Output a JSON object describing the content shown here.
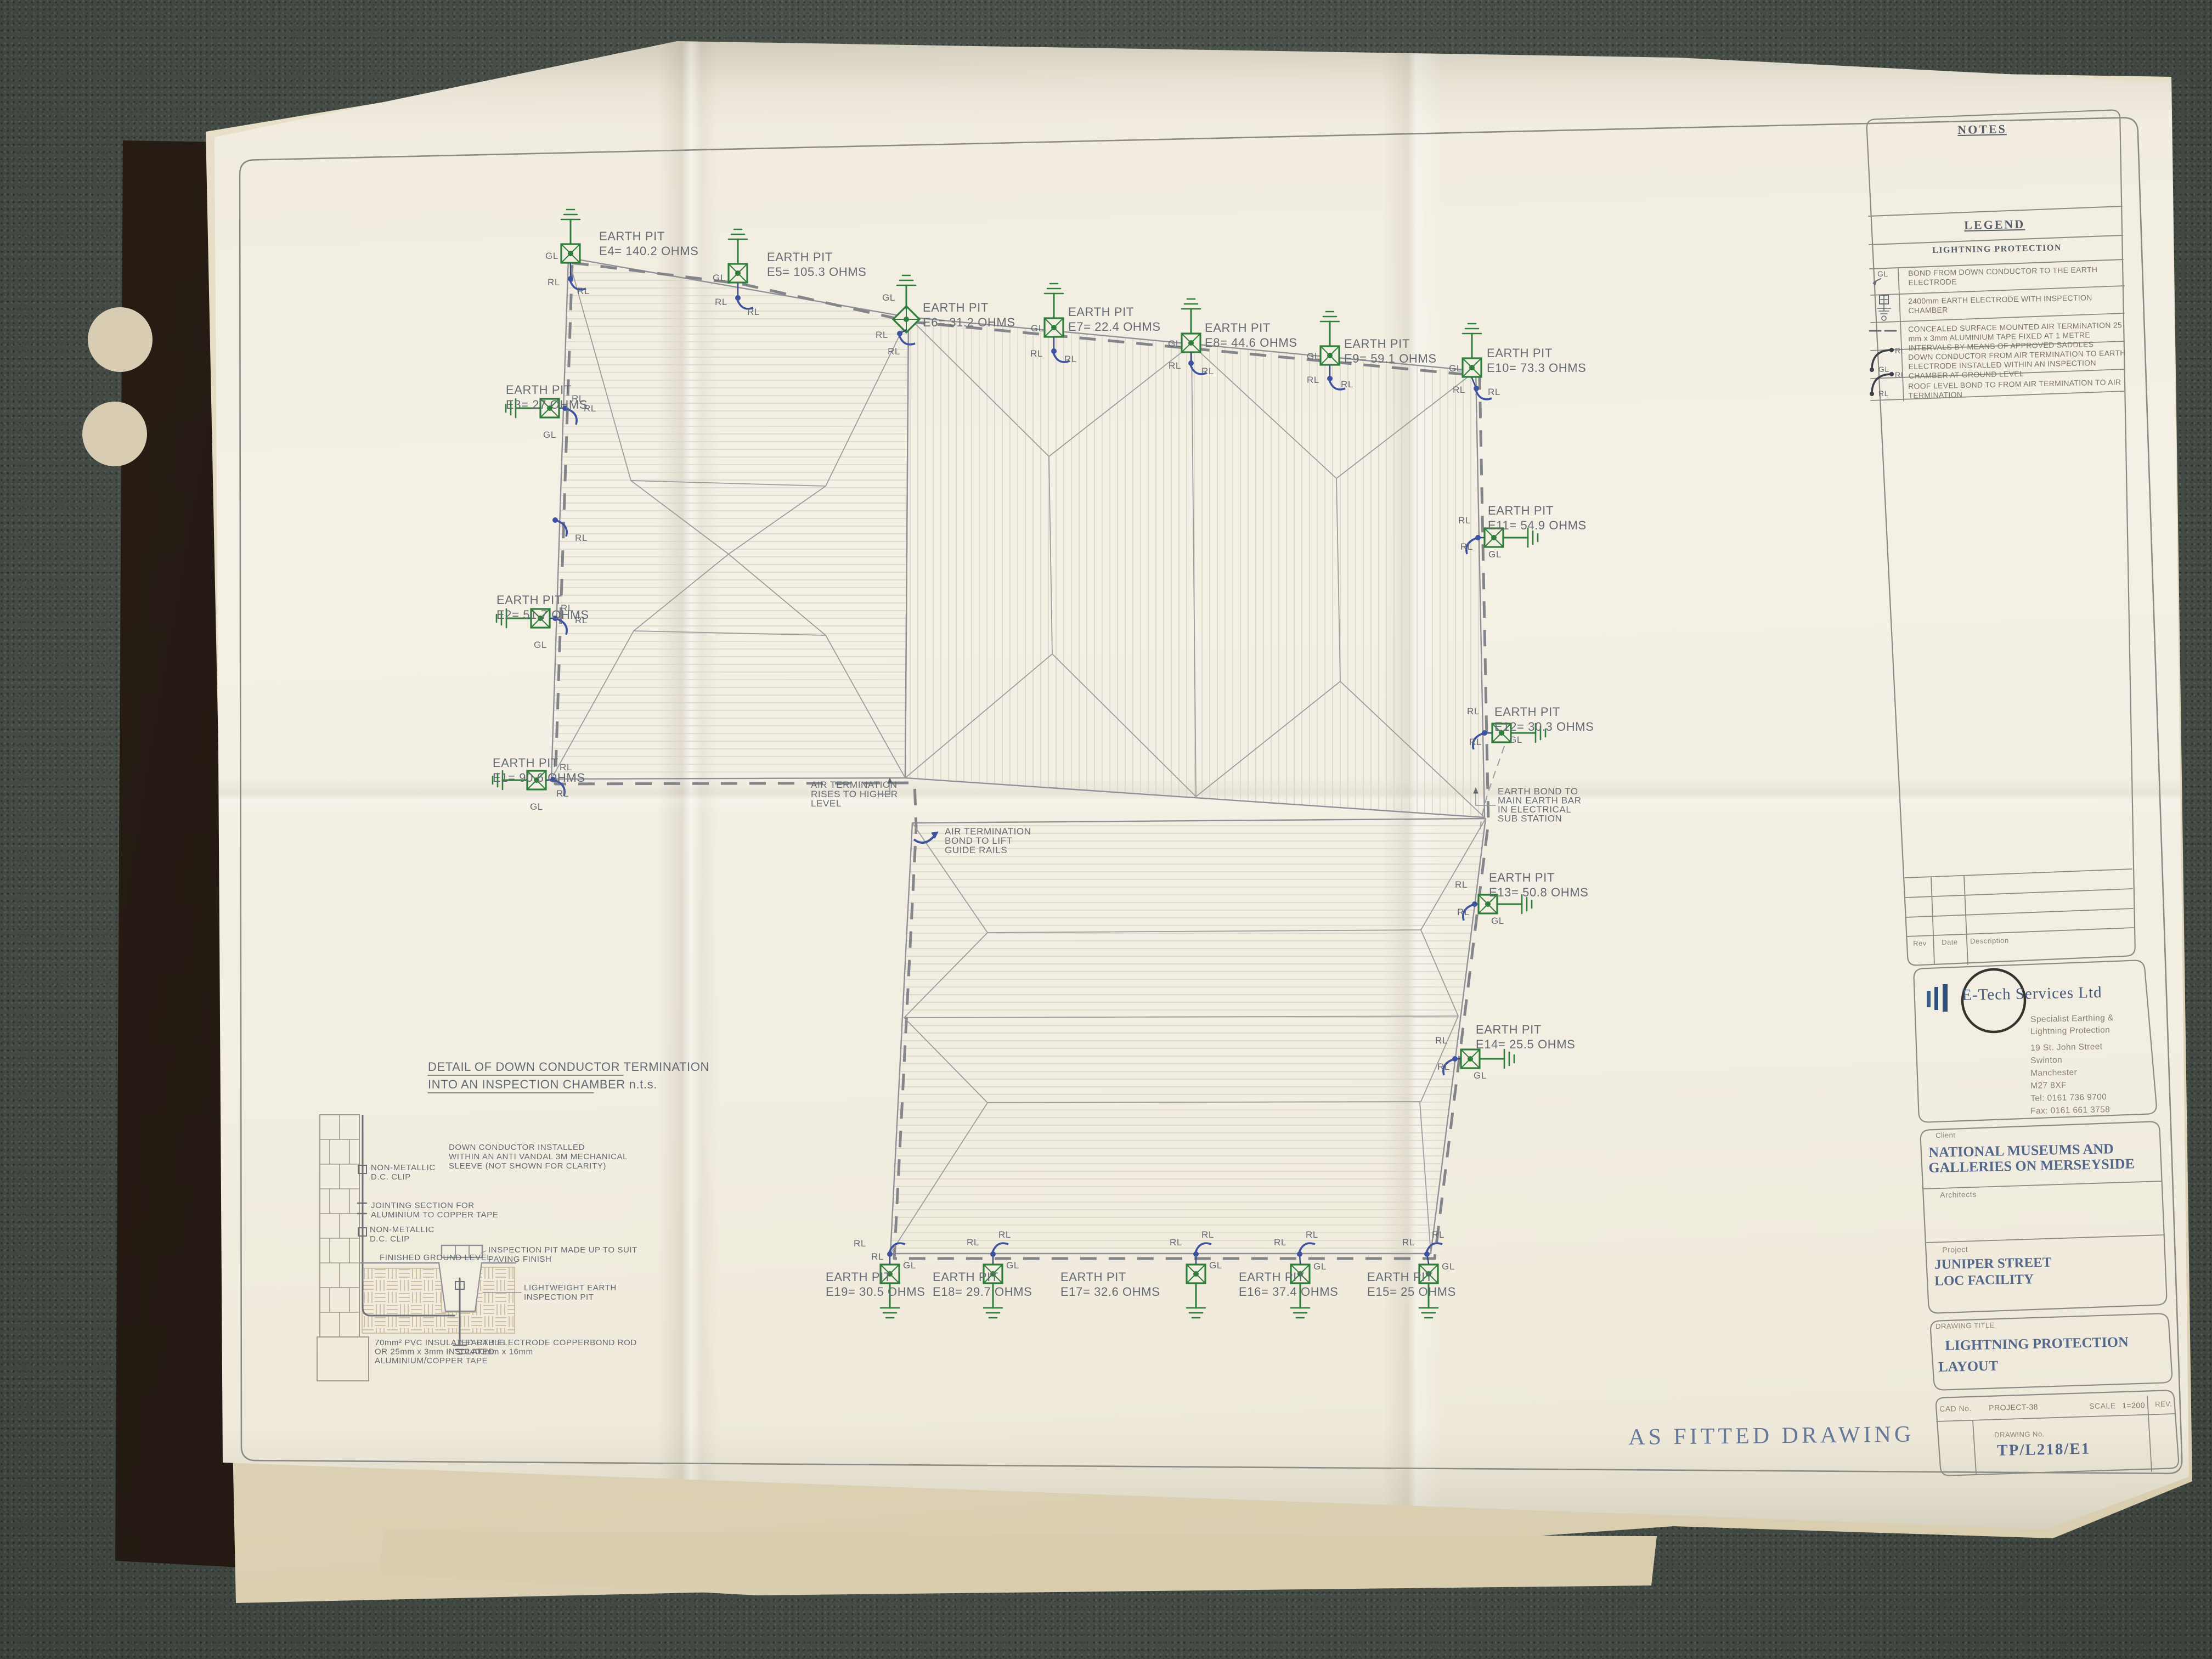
{
  "page": {
    "as_fitted": "AS FITTED DRAWING"
  },
  "colors": {
    "pit_green": "#2e7d3a",
    "conductor_blue": "#3d52a0",
    "stamp_blue": "#53678a",
    "line_gray": "#8f9196",
    "paper": "#f2eee2"
  },
  "legend": {
    "notes_title": "NOTES",
    "title": "LEGEND",
    "subtitle": "LIGHTNING PROTECTION",
    "rows": [
      {
        "symbol": "gl-bond-icon",
        "tags": [
          "GL"
        ],
        "text": "BOND FROM DOWN CONDUCTOR TO THE EARTH ELECTRODE"
      },
      {
        "symbol": "earth-electrode-icon",
        "tags": [],
        "text": "2400mm EARTH ELECTRODE WITH INSPECTION CHAMBER"
      },
      {
        "symbol": "air-termination-tape-icon",
        "tags": [],
        "text": "CONCEALED SURFACE MOUNTED AIR TERMINATION 25 mm x 3mm ALUMINIUM TAPE FIXED AT 1 METRE INTERVALS BY MEANS OF APPROVED SADDLES"
      },
      {
        "symbol": "down-conductor-icon",
        "tags": [
          "RL",
          "GL"
        ],
        "text": "DOWN CONDUCTOR FROM AIR TERMINATION TO EARTH ELECTRODE INSTALLED WITHIN AN INSPECTION CHAMBER AT GROUND LEVEL"
      },
      {
        "symbol": "roof-bond-icon",
        "tags": [
          "RL",
          "RL"
        ],
        "text": "ROOF LEVEL BOND TO FROM AIR TERMINATION TO AIR TERMINATION"
      }
    ]
  },
  "revision_table": {
    "headers": [
      "Rev",
      "Date",
      "Description"
    ]
  },
  "company": {
    "name": "E-Tech Services Ltd",
    "tagline1": "Specialist Earthing &",
    "tagline2": "Lightning Protection",
    "address": [
      "19 St. John Street",
      "Swinton",
      "Manchester",
      "M27 8XF",
      "Tel: 0161 736 9700",
      "Fax: 0161 661 3758"
    ]
  },
  "titleblock": {
    "client_label": "Client",
    "client_line1": "NATIONAL MUSEUMS AND",
    "client_line2": "GALLERIES ON MERSEYSIDE",
    "architects_label": "Architects",
    "project_label": "Project",
    "project_line1": "JUNIPER STREET",
    "project_line2": "LOC FACILITY",
    "drawing_title_label": "DRAWING TITLE",
    "drawing_title_line1": "LIGHTNING PROTECTION",
    "drawing_title_line2": "LAYOUT",
    "cad_no_label": "CAD No.",
    "cad_no": "PROJECT-38",
    "scale_label": "SCALE",
    "scale_value": "1=200",
    "rev_label": "REV.",
    "drawing_no_label": "DRAWING No.",
    "drawing_no": "TP/L218/E1"
  },
  "plan": {
    "pit_title": "EARTH PIT",
    "rl": "RL",
    "gl": "GL",
    "pits": [
      {
        "id": "E1",
        "reading": "E1= 90.6 OHMS"
      },
      {
        "id": "E2",
        "reading": "E2= 51.7 OHMS"
      },
      {
        "id": "E3",
        "reading": "E3= 27 OHMS"
      },
      {
        "id": "E4",
        "reading": "E4= 140.2 OHMS"
      },
      {
        "id": "E5",
        "reading": "E5= 105.3 OHMS"
      },
      {
        "id": "E6",
        "reading": "E6= 31.2 OHMS"
      },
      {
        "id": "E7",
        "reading": "E7= 22.4 OHMS"
      },
      {
        "id": "E8",
        "reading": "E8= 44.6 OHMS"
      },
      {
        "id": "E9",
        "reading": "E9= 59.1 OHMS"
      },
      {
        "id": "E10",
        "reading": "E10= 73.3 OHMS"
      },
      {
        "id": "E11",
        "reading": "E11= 54.9 OHMS"
      },
      {
        "id": "E12",
        "reading": "E12= 30.3 OHMS"
      },
      {
        "id": "E13",
        "reading": "E13= 50.8 OHMS"
      },
      {
        "id": "E14",
        "reading": "E14= 25.5 OHMS"
      },
      {
        "id": "E15",
        "reading": "E15= 25 OHMS"
      },
      {
        "id": "E16",
        "reading": "E16= 37.4 OHMS"
      },
      {
        "id": "E17",
        "reading": "E17= 32.6 OHMS"
      },
      {
        "id": "E18",
        "reading": "E18= 29.7 OHMS"
      },
      {
        "id": "E19",
        "reading": "E19= 30.5 OHMS"
      }
    ],
    "notes": {
      "air_rise": [
        "AIR TERMINATION",
        "RISES TO HIGHER",
        "LEVEL"
      ],
      "air_lift": [
        "AIR TERMINATION",
        "BOND TO LIFT",
        "GUIDE RAILS"
      ],
      "earth_bond": [
        "EARTH BOND TO",
        "MAIN EARTH BAR",
        "IN ELECTRICAL",
        "SUB STATION"
      ]
    }
  },
  "detail": {
    "title_line1": "DETAIL OF DOWN CONDUCTOR TERMINATION",
    "title_line2": "INTO AN INSPECTION CHAMBER n.t.s.",
    "labels": {
      "clip": [
        "NON-METALLIC",
        "D.C. CLIP"
      ],
      "jointing": [
        "JOINTING SECTION FOR",
        "ALUMINIUM TO COPPER TAPE"
      ],
      "sleeve": [
        "DOWN CONDUCTOR INSTALLED",
        "WITHIN AN ANTI VANDAL 3M MECHANICAL",
        "SLEEVE  (NOT SHOWN FOR CLARITY)"
      ],
      "fgl": [
        "FINISHED GROUND LEVEL"
      ],
      "pit_paving": [
        "INSPECTION PIT MADE UP TO SUIT",
        "PAVING FINISH"
      ],
      "lightweight": [
        "LIGHTWEIGHT EARTH",
        "INSPECTION PIT"
      ],
      "cable": [
        "70mm² PVC INSULATED CABLE",
        "OR 25mm x 3mm INSULATED",
        "ALUMINIUM/COPPER TAPE"
      ],
      "rod": [
        "EARTH ELECTRODE COPPERBOND ROD",
        "2400mm x 16mm"
      ]
    }
  }
}
